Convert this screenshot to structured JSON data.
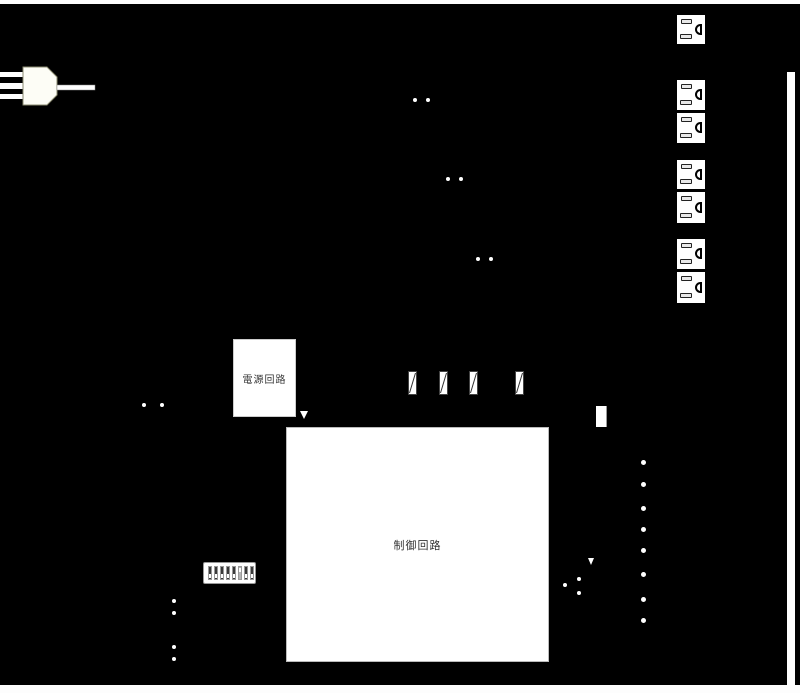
{
  "figure": {
    "background_color": "#000000",
    "shape_color": "#ffffff",
    "power_supply_box_label": "電源回路",
    "control_box_label": "制御回路",
    "counts": {
      "single_outlets": 1,
      "outlet_pairs": 3,
      "fuses": 4,
      "dip_switch_positions": 8,
      "indicator_dots": 8
    }
  }
}
